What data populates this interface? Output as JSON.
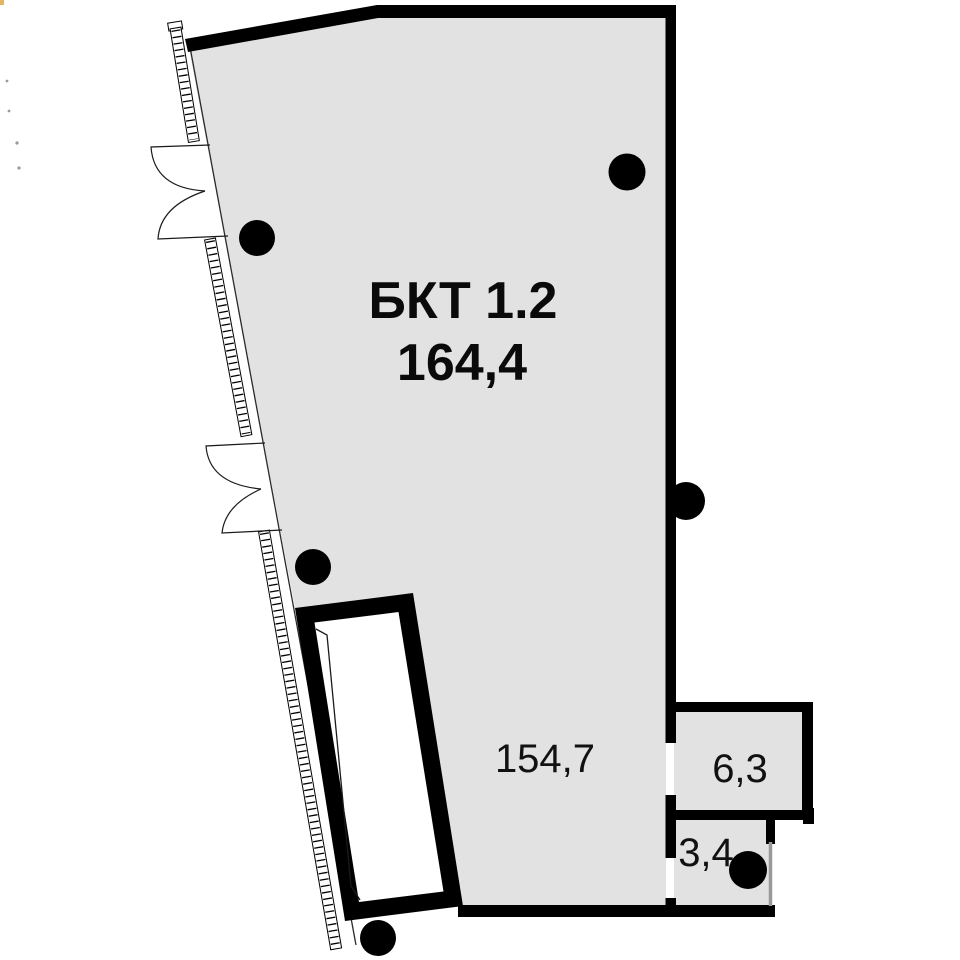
{
  "plan": {
    "unit_label": "БКТ 1.2",
    "unit_area": "164,4",
    "rooms": [
      {
        "id": "main-room",
        "area_label": "154,7"
      },
      {
        "id": "room-6-3",
        "area_label": "6,3"
      },
      {
        "id": "room-3-4",
        "area_label": "3,4"
      }
    ],
    "colors": {
      "background": "#ffffff",
      "floor": "#e2e2e2",
      "wall": "#000000",
      "marker": "#000000",
      "partition": "#999999"
    }
  }
}
